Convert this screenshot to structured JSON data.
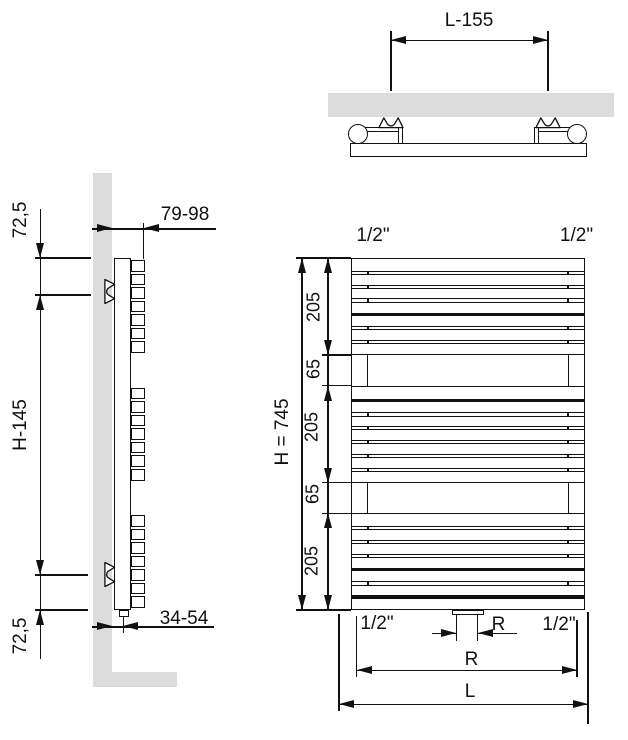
{
  "colors": {
    "line": "#111111",
    "wall": "#dcdcdc",
    "background": "#ffffff"
  },
  "top_view": {
    "dim_bracket_span": "L-155"
  },
  "side_view": {
    "dim_top_offset": "72,5",
    "dim_bracket_span": "H-145",
    "dim_bottom_offset": "72,5",
    "dim_depth": "79-98",
    "dim_pipe_offset": "34-54"
  },
  "front_view": {
    "dim_conn_top_left": "1/2\"",
    "dim_conn_top_right": "1/2\"",
    "dim_total_height": "H = 745",
    "dim_segments": [
      "205",
      "65",
      "205",
      "65",
      "205"
    ],
    "dim_conn_bottom_left": "1/2\"",
    "dim_conn_bottom_right": "1/2\"",
    "dim_center_conn": "R",
    "dim_conn_span": "R",
    "dim_length": "L",
    "tube_sections": [
      {
        "top": 258,
        "height": 97,
        "separators": [
          "thin",
          "thin",
          "thin",
          "thick",
          "thin",
          "thin"
        ]
      },
      {
        "top": 385.7,
        "height": 96.9,
        "separators": [
          "thick",
          "thin",
          "thin",
          "thin",
          "thin",
          "thin"
        ]
      },
      {
        "top": 513.3,
        "height": 96.7,
        "separators": [
          "thin",
          "thin",
          "thin",
          "thick",
          "thin",
          "thick"
        ]
      }
    ],
    "gaps": [
      {
        "top": 355,
        "height": 30.7
      },
      {
        "top": 482.6,
        "height": 30.7
      }
    ]
  }
}
